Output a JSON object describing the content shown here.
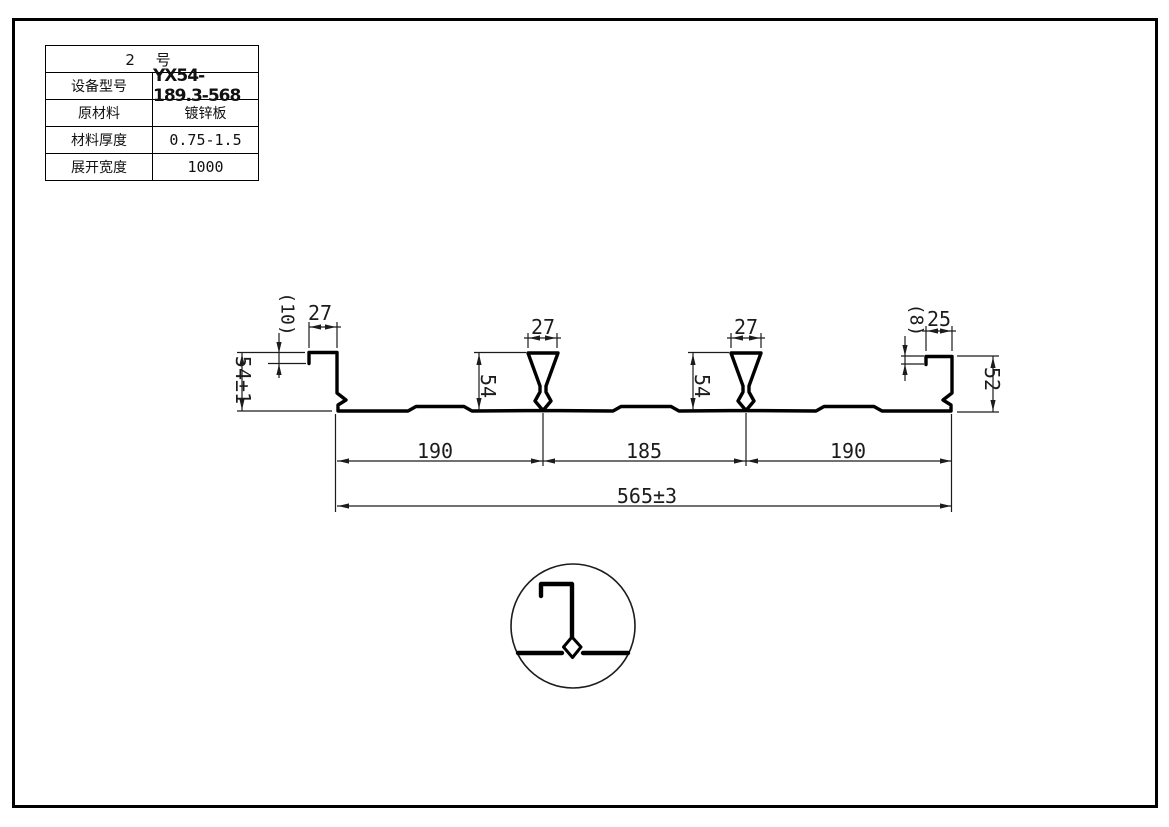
{
  "table": {
    "title": "2 号",
    "rows": [
      {
        "label": "设备型号",
        "value": "YX54-189.3-568"
      },
      {
        "label": "原材料",
        "value": "镀锌板"
      },
      {
        "label": "材料厚度",
        "value": "0.75-1.5"
      },
      {
        "label": "展开宽度",
        "value": "1000"
      }
    ]
  },
  "dims": {
    "left_lip": "(10)",
    "left_top": "27",
    "left_height": "54±1",
    "rib1_top": "27",
    "rib1_height": "54",
    "rib2_top": "27",
    "rib2_height": "54",
    "right_lip": "(8)",
    "right_top": "25",
    "right_height": "52",
    "span_left": "190",
    "span_mid": "185",
    "span_right": "190",
    "overall": "565±3"
  },
  "colors": {
    "line": "#000000",
    "background": "#ffffff"
  }
}
